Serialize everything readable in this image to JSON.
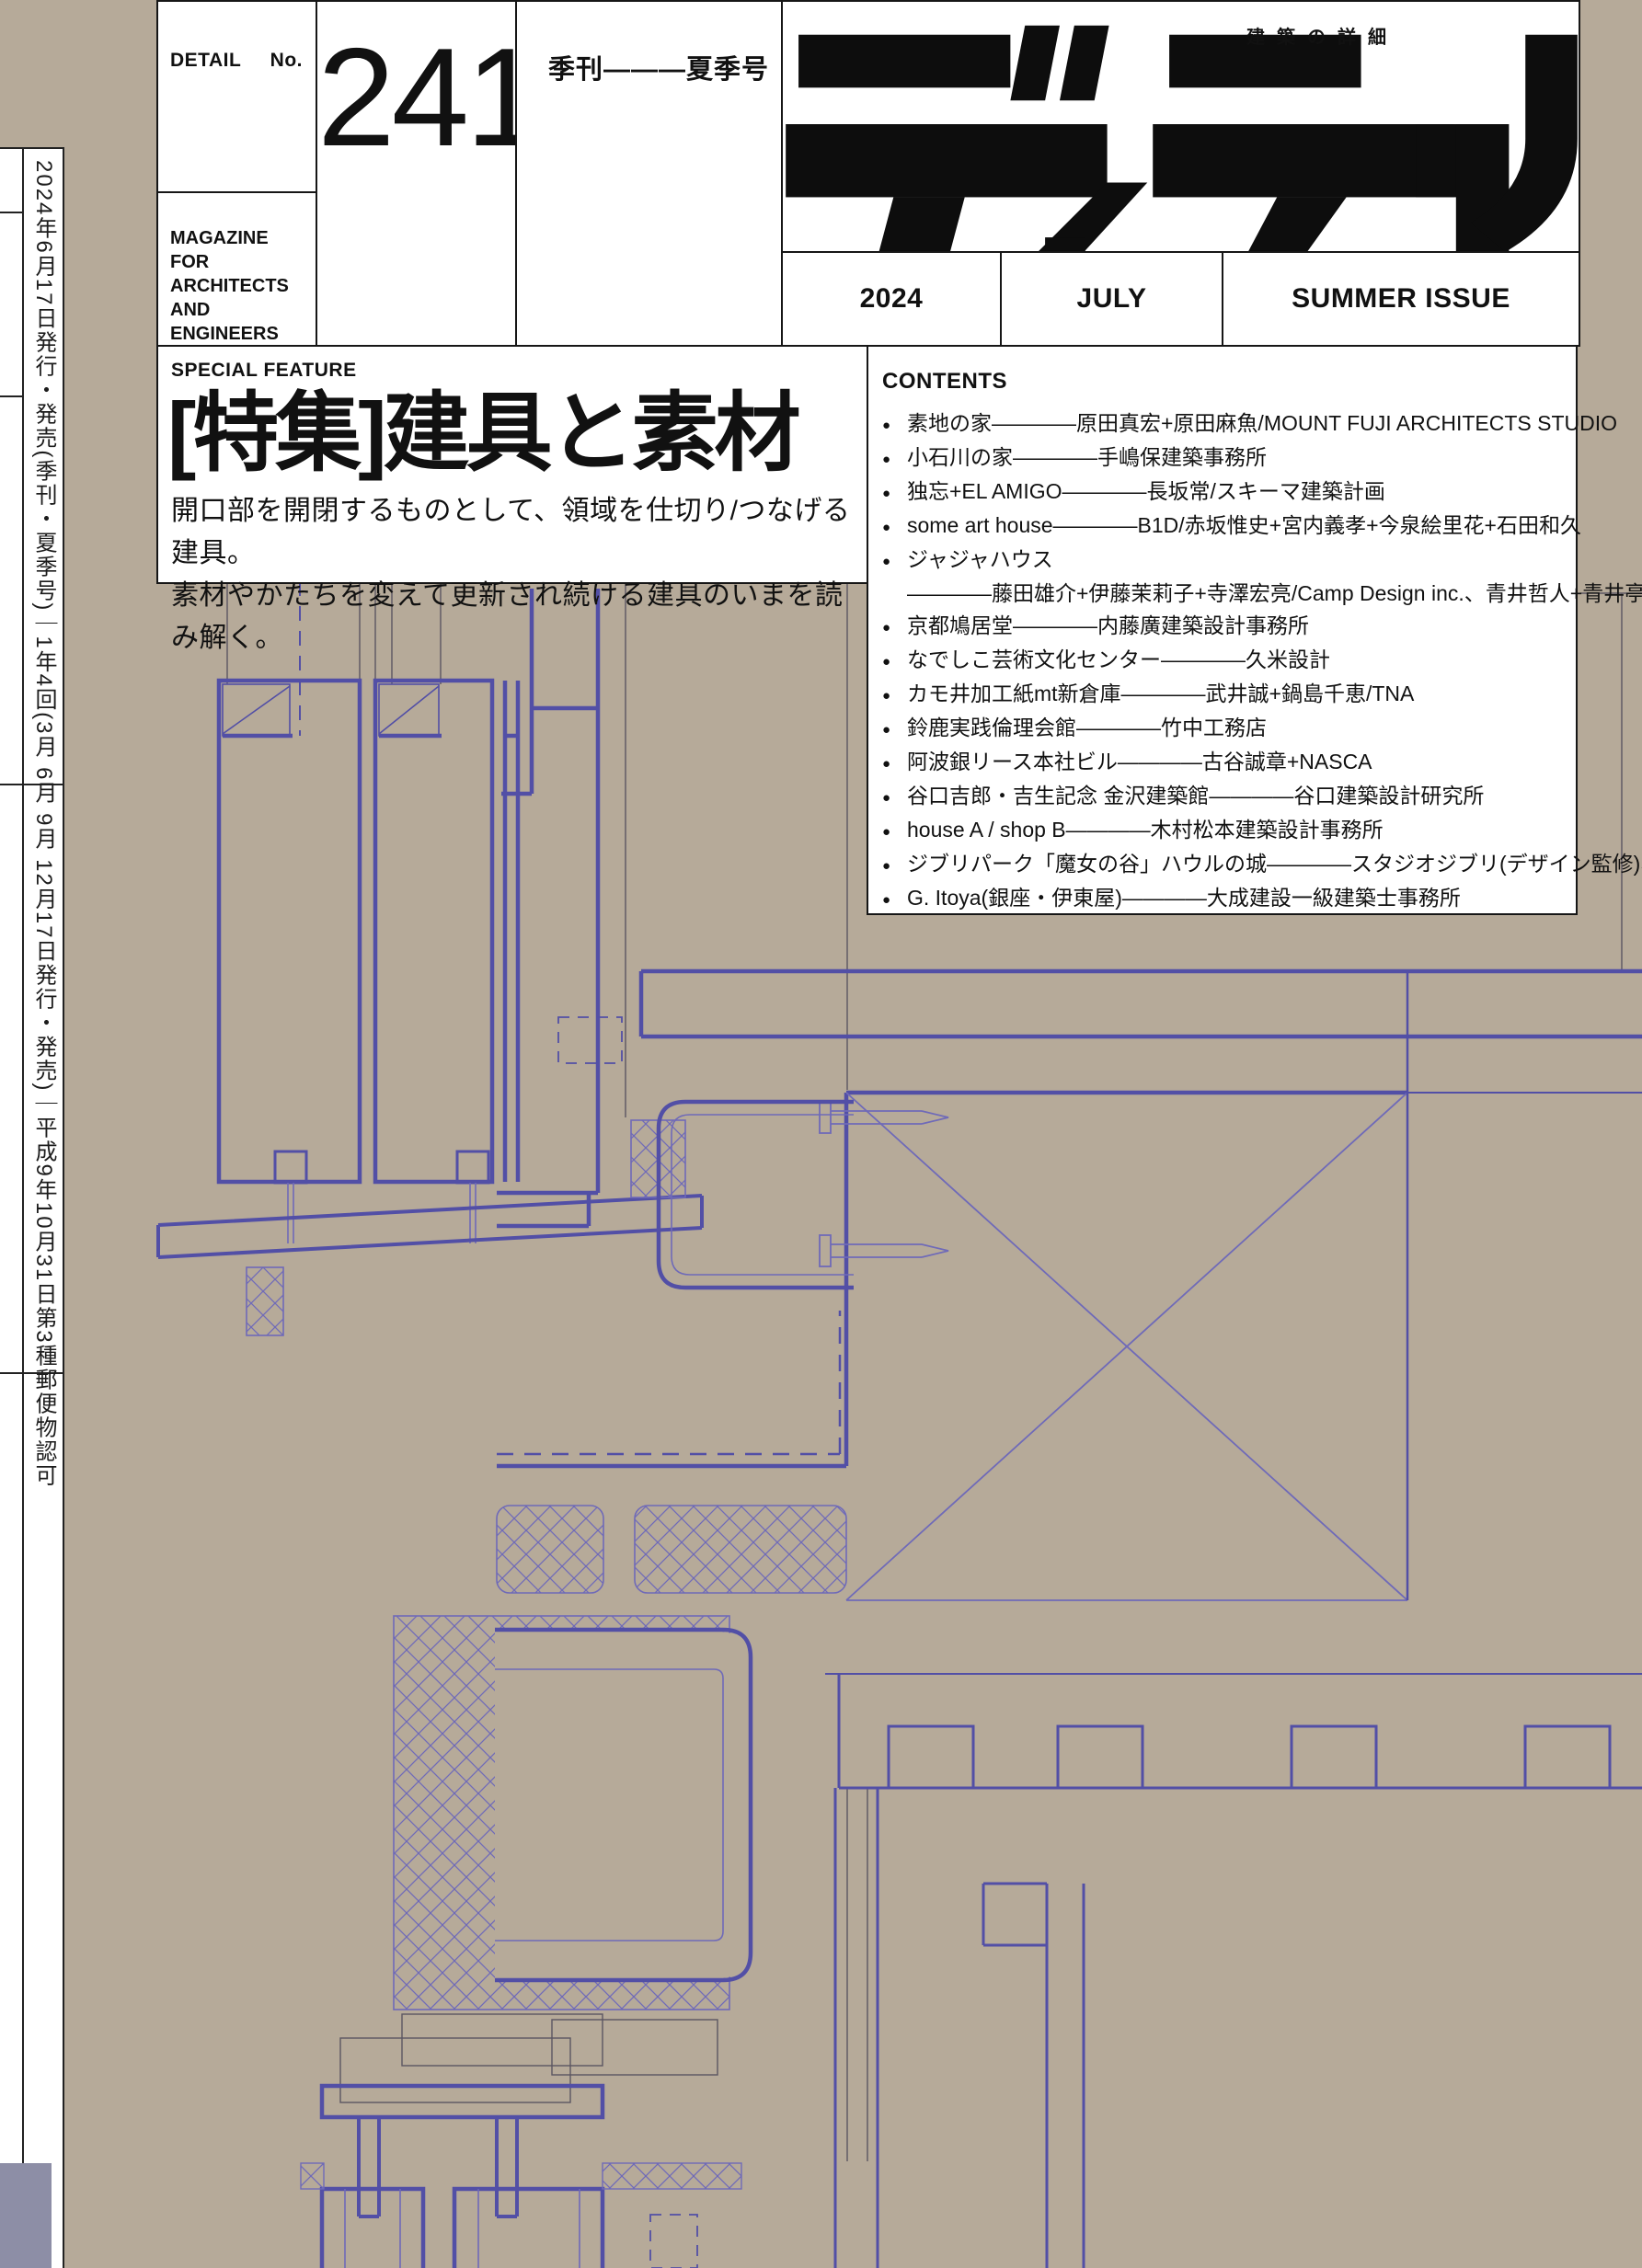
{
  "colors": {
    "background_tan": "#b6aa99",
    "drawing_purple": "#524fa6",
    "drawing_purple_thin": "#6f6ab8",
    "drawing_gray": "#5b5662",
    "box_white": "#ffffff",
    "ink_black": "#161616",
    "sidebar_block_blue": "#8d8ea6"
  },
  "masthead": {
    "detail_label": "DETAIL",
    "no_label": "No.",
    "issue_number": "241",
    "quarterly_label": "季刊———夏季号",
    "magazine_for": "MAGAZINE\nFOR\nARCHITECTS\nAND\nENGINEERS",
    "logo_text": "ディテール",
    "logo_subtitle": "建築の詳細",
    "year": "2024",
    "month": "JULY",
    "issue_label": "SUMMER ISSUE"
  },
  "feature": {
    "label": "SPECIAL FEATURE",
    "title": "[特集]建具と素材",
    "desc_line1": "開口部を開閉するものとして、領域を仕切り/つなげる建具。",
    "desc_line2": "素材やかたちを変えて更新され続ける建具のいまを読み解く。"
  },
  "contents": {
    "label": "CONTENTS",
    "items": [
      {
        "bullet": true,
        "text": "素地の家————原田真宏+原田麻魚/MOUNT FUJI ARCHITECTS STUDIO"
      },
      {
        "bullet": true,
        "text": "小石川の家————手嶋保建築事務所"
      },
      {
        "bullet": true,
        "text": "独忘+EL AMIGO————長坂常/スキーマ建築計画"
      },
      {
        "bullet": true,
        "text": "some art house————B1D/赤坂惟史+宮内義孝+今泉絵里花+石田和久"
      },
      {
        "bullet": true,
        "text": "ジャジャハウス"
      },
      {
        "bullet": false,
        "text": "————藤田雄介+伊藤茉莉子+寺澤宏亮/Camp Design inc.、青井哲人+青井亭菲"
      },
      {
        "bullet": true,
        "text": "京都鳩居堂————内藤廣建築設計事務所"
      },
      {
        "bullet": true,
        "text": "なでしこ芸術文化センター————久米設計"
      },
      {
        "bullet": true,
        "text": "カモ井加工紙mt新倉庫————武井誠+鍋島千恵/TNA"
      },
      {
        "bullet": true,
        "text": "鈴鹿実践倫理会館————竹中工務店"
      },
      {
        "bullet": true,
        "text": "阿波銀リース本社ビル————古谷誠章+NASCA"
      },
      {
        "bullet": true,
        "text": "谷口吉郎・吉生記念 金沢建築館————谷口建築設計研究所"
      },
      {
        "bullet": true,
        "text": "house A / shop B————木村松本建築設計事務所"
      },
      {
        "bullet": true,
        "text": "ジブリパーク「魔女の谷」ハウルの城————スタジオジブリ(デザイン監修)、日本設計"
      },
      {
        "bullet": true,
        "text": "G. Itoya(銀座・伊東屋)————大成建設一級建築士事務所"
      }
    ]
  },
  "sidebar": {
    "publication_info": "2024年6月17日発行・発売(季刊・夏季号)｜1年4回(3月 6月 9月 12月17日発行・発売)｜平成9年10月31日第3種郵便物認可"
  }
}
